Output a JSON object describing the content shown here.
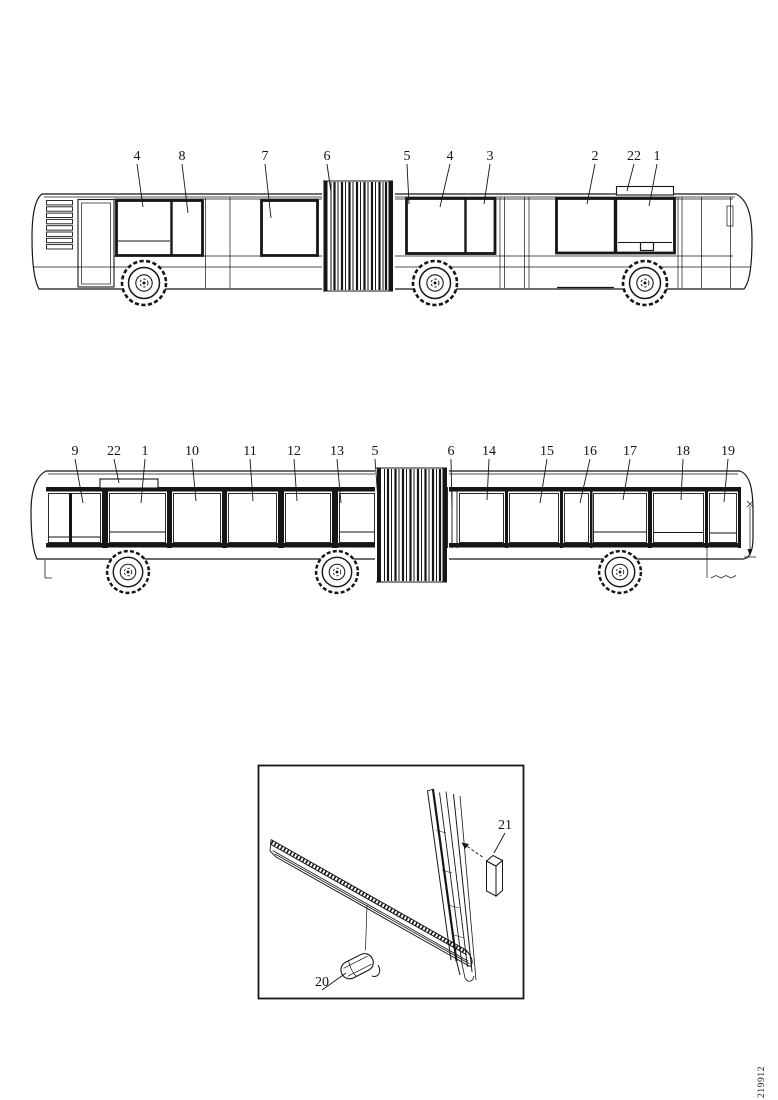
{
  "page": {
    "background_color": "#ffffff",
    "line_color": "#161616",
    "drawing_number": "219912"
  },
  "views": {
    "top_view": {
      "description": "articulated bus left side elevation",
      "callouts": [
        {
          "label": "4",
          "x": 137,
          "y": 160,
          "tip_x": 143,
          "tip_y": 207
        },
        {
          "label": "8",
          "x": 182,
          "y": 160,
          "tip_x": 188,
          "tip_y": 213
        },
        {
          "label": "7",
          "x": 265,
          "y": 160,
          "tip_x": 271,
          "tip_y": 218
        },
        {
          "label": "6",
          "x": 327,
          "y": 160,
          "tip_x": 331,
          "tip_y": 192
        },
        {
          "label": "5",
          "x": 407,
          "y": 160,
          "tip_x": 409,
          "tip_y": 204
        },
        {
          "label": "4",
          "x": 450,
          "y": 160,
          "tip_x": 440,
          "tip_y": 207
        },
        {
          "label": "3",
          "x": 490,
          "y": 160,
          "tip_x": 484,
          "tip_y": 204
        },
        {
          "label": "2",
          "x": 595,
          "y": 160,
          "tip_x": 587,
          "tip_y": 204
        },
        {
          "label": "22",
          "x": 634,
          "y": 160,
          "tip_x": 627,
          "tip_y": 191
        },
        {
          "label": "1",
          "x": 657,
          "y": 160,
          "tip_x": 649,
          "tip_y": 206
        }
      ]
    },
    "bottom_view": {
      "description": "articulated bus right side elevation",
      "callouts": [
        {
          "label": "9",
          "x": 75,
          "y": 455,
          "tip_x": 83,
          "tip_y": 503
        },
        {
          "label": "22",
          "x": 114,
          "y": 455,
          "tip_x": 119,
          "tip_y": 483
        },
        {
          "label": "1",
          "x": 145,
          "y": 455,
          "tip_x": 141,
          "tip_y": 503
        },
        {
          "label": "10",
          "x": 192,
          "y": 455,
          "tip_x": 196,
          "tip_y": 501
        },
        {
          "label": "11",
          "x": 250,
          "y": 455,
          "tip_x": 253,
          "tip_y": 501
        },
        {
          "label": "12",
          "x": 294,
          "y": 455,
          "tip_x": 297,
          "tip_y": 501
        },
        {
          "label": "13",
          "x": 337,
          "y": 455,
          "tip_x": 341,
          "tip_y": 503
        },
        {
          "label": "5",
          "x": 375,
          "y": 455,
          "tip_x": 378,
          "tip_y": 500
        },
        {
          "label": "6",
          "x": 451,
          "y": 455,
          "tip_x": 452,
          "tip_y": 508
        },
        {
          "label": "14",
          "x": 489,
          "y": 455,
          "tip_x": 487,
          "tip_y": 500
        },
        {
          "label": "15",
          "x": 547,
          "y": 455,
          "tip_x": 540,
          "tip_y": 503
        },
        {
          "label": "16",
          "x": 590,
          "y": 455,
          "tip_x": 580,
          "tip_y": 503
        },
        {
          "label": "17",
          "x": 630,
          "y": 455,
          "tip_x": 623,
          "tip_y": 500
        },
        {
          "label": "18",
          "x": 683,
          "y": 455,
          "tip_x": 681,
          "tip_y": 500
        },
        {
          "label": "19",
          "x": 728,
          "y": 455,
          "tip_x": 724,
          "tip_y": 502
        }
      ]
    },
    "detail_inset": {
      "description": "window frame lower corner detail",
      "callouts": [
        {
          "label": "21",
          "x": 505,
          "y": 829,
          "tip_x": 494,
          "tip_y": 853
        },
        {
          "label": "20",
          "x": 322,
          "y": 986,
          "tip_x": 346,
          "tip_y": 973
        }
      ]
    }
  }
}
